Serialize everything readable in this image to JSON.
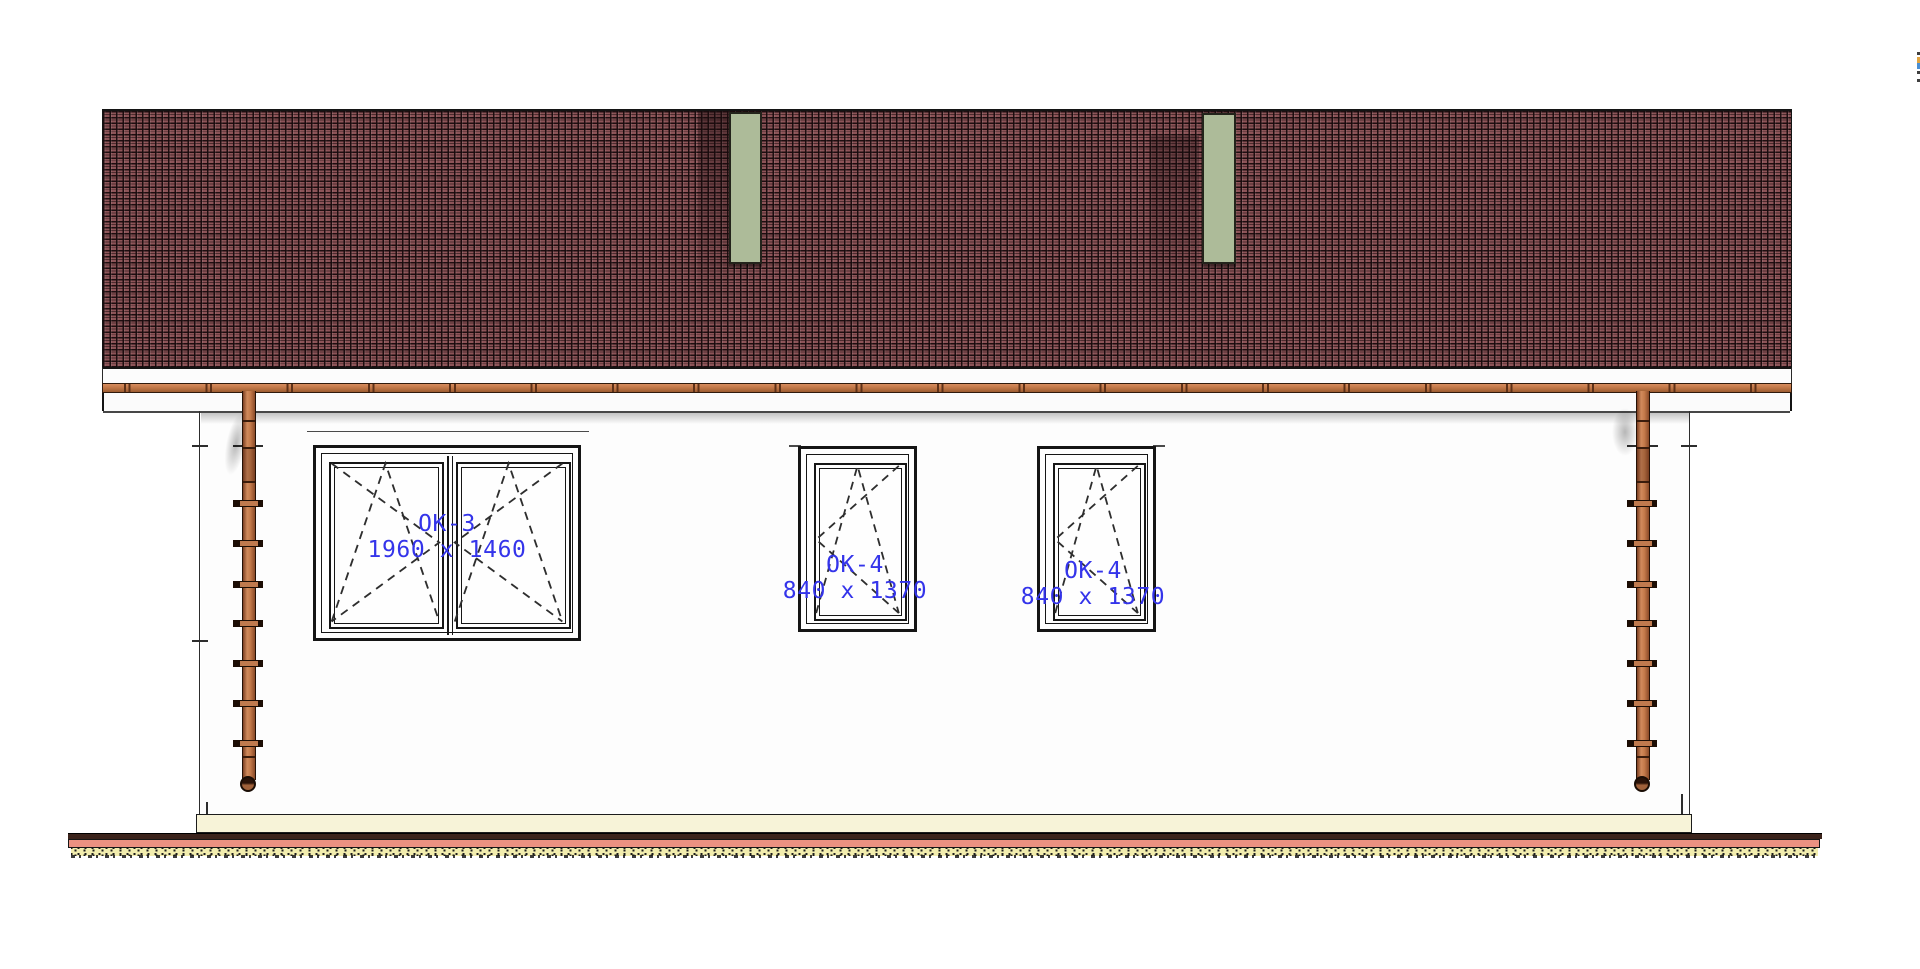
{
  "view": {
    "type": "architectural-elevation",
    "description": "Rear elevation of a single-storey house with tiled roof, gutter, two downpipes and three windows"
  },
  "windows": [
    {
      "tag": "OK-3",
      "size": "1960 x 1460"
    },
    {
      "tag": "OK-4",
      "size": "840 x 1370"
    },
    {
      "tag": "OK-4",
      "size": "840 x 1370"
    }
  ],
  "colors": {
    "roof_tile": "#8d5458",
    "roof_gap": "#180a0c",
    "roof_panel_green": "#adbb99",
    "gutter_copper": "#c27848",
    "downpipe_copper": "#c07a4e",
    "wall": "#fdfdfd",
    "plinth": "#f7f3d8",
    "ground_base_line": "#3b231b",
    "ground_band": "#ec9181",
    "ground_hatch": "#f2edae",
    "label_blue": "#3434ea",
    "drawing_line": "#151515"
  }
}
